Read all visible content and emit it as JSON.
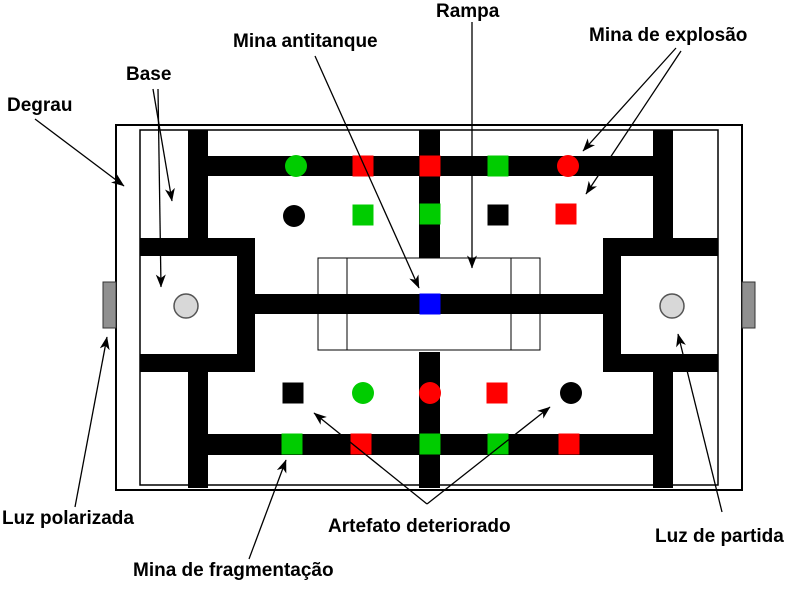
{
  "figure": {
    "background": "#ffffff",
    "colors": {
      "wall": "#000000",
      "green": "#00cc00",
      "red": "#ff0000",
      "blue": "#0000ff",
      "black": "#000000",
      "step_gray": "#909090",
      "light_gray": "#d8d8d8",
      "light_stroke": "#555555"
    },
    "labels": [
      {
        "id": "degrau",
        "text": "Degrau",
        "x": 7,
        "y": 95
      },
      {
        "id": "base",
        "text": "Base",
        "x": 126,
        "y": 64
      },
      {
        "id": "mina-antitanque",
        "text": "Mina antitanque",
        "x": 233,
        "y": 31
      },
      {
        "id": "rampa",
        "text": "Rampa",
        "x": 436,
        "y": 1
      },
      {
        "id": "mina-de-explosao",
        "text": "Mina de explosão",
        "x": 589,
        "y": 25
      },
      {
        "id": "luz-polarizada",
        "text": "Luz polarizada",
        "x": 2,
        "y": 508
      },
      {
        "id": "mina-de-fragmentacao",
        "text": "Mina de fragmentação",
        "x": 133,
        "y": 560
      },
      {
        "id": "artefato-deteriorado",
        "text": "Artefato deteriorado",
        "x": 328,
        "y": 516
      },
      {
        "id": "luz-de-partida",
        "text": "Luz de partida",
        "x": 655,
        "y": 526
      }
    ],
    "arena": {
      "outer": {
        "x": 116,
        "y": 125,
        "w": 626,
        "h": 365
      },
      "inner": {
        "x": 140,
        "y": 130,
        "w": 578,
        "h": 355
      },
      "walls": [
        {
          "id": "left-wall-upper",
          "x": 188,
          "y": 130,
          "w": 20,
          "h": 108
        },
        {
          "id": "left-wall-lower",
          "x": 188,
          "y": 372,
          "w": 20,
          "h": 116
        },
        {
          "id": "center-wall-upper",
          "x": 419,
          "y": 130,
          "w": 21,
          "h": 128
        },
        {
          "id": "center-wall-lower",
          "x": 419,
          "y": 352,
          "w": 21,
          "h": 136
        },
        {
          "id": "right-wall-upper",
          "x": 653,
          "y": 130,
          "w": 20,
          "h": 108
        },
        {
          "id": "right-wall-lower",
          "x": 653,
          "y": 372,
          "w": 20,
          "h": 116
        },
        {
          "id": "top-path",
          "x": 208,
          "y": 156,
          "w": 445,
          "h": 20
        },
        {
          "id": "bottom-path",
          "x": 208,
          "y": 434,
          "w": 445,
          "h": 21
        },
        {
          "id": "left-base-top",
          "x": 140,
          "y": 238,
          "w": 115,
          "h": 18
        },
        {
          "id": "left-base-right",
          "x": 237,
          "y": 238,
          "w": 18,
          "h": 134
        },
        {
          "id": "left-base-bottom",
          "x": 140,
          "y": 354,
          "w": 115,
          "h": 18
        },
        {
          "id": "right-base-top",
          "x": 603,
          "y": 238,
          "w": 115,
          "h": 18
        },
        {
          "id": "right-base-left",
          "x": 603,
          "y": 238,
          "w": 18,
          "h": 134
        },
        {
          "id": "right-base-bottom",
          "x": 603,
          "y": 354,
          "w": 115,
          "h": 18
        },
        {
          "id": "center-path",
          "x": 255,
          "y": 294,
          "w": 348,
          "h": 20
        }
      ],
      "ramp": {
        "x": 318,
        "y": 258,
        "w": 222,
        "h": 92,
        "inner_lines_x": [
          347,
          511
        ]
      },
      "steps": [
        {
          "id": "left-step",
          "x": 103,
          "y": 282,
          "w": 13,
          "h": 46
        },
        {
          "id": "right-step",
          "x": 742,
          "y": 282,
          "w": 13,
          "h": 46
        }
      ],
      "lights": [
        {
          "id": "left-start-light",
          "cx": 186,
          "cy": 306,
          "r": 12
        },
        {
          "id": "right-start-light",
          "cx": 672,
          "cy": 306,
          "r": 12
        }
      ]
    },
    "mine_size": {
      "square": 21,
      "circle_r": 11
    },
    "mines": [
      {
        "shape": "circle",
        "color": "green",
        "cx": 296,
        "cy": 166
      },
      {
        "shape": "square",
        "color": "red",
        "cx": 363,
        "cy": 166
      },
      {
        "shape": "square",
        "color": "red",
        "cx": 430,
        "cy": 166
      },
      {
        "shape": "square",
        "color": "green",
        "cx": 498,
        "cy": 166
      },
      {
        "shape": "circle",
        "color": "red",
        "cx": 568,
        "cy": 166
      },
      {
        "shape": "circle",
        "color": "black",
        "cx": 294,
        "cy": 216
      },
      {
        "shape": "square",
        "color": "green",
        "cx": 363,
        "cy": 215
      },
      {
        "shape": "square",
        "color": "green",
        "cx": 430,
        "cy": 214
      },
      {
        "shape": "square",
        "color": "black",
        "cx": 498,
        "cy": 215
      },
      {
        "shape": "square",
        "color": "red",
        "cx": 566,
        "cy": 214
      },
      {
        "shape": "square",
        "color": "black",
        "cx": 293,
        "cy": 393
      },
      {
        "shape": "circle",
        "color": "green",
        "cx": 363,
        "cy": 393
      },
      {
        "shape": "circle",
        "color": "red",
        "cx": 430,
        "cy": 393
      },
      {
        "shape": "square",
        "color": "red",
        "cx": 497,
        "cy": 393
      },
      {
        "shape": "circle",
        "color": "black",
        "cx": 571,
        "cy": 393
      },
      {
        "shape": "square",
        "color": "green",
        "cx": 292,
        "cy": 444
      },
      {
        "shape": "square",
        "color": "red",
        "cx": 361,
        "cy": 444
      },
      {
        "shape": "square",
        "color": "green",
        "cx": 430,
        "cy": 444
      },
      {
        "shape": "square",
        "color": "green",
        "cx": 498,
        "cy": 444
      },
      {
        "shape": "square",
        "color": "red",
        "cx": 569,
        "cy": 444
      },
      {
        "shape": "square",
        "color": "blue",
        "cx": 430,
        "cy": 304
      }
    ],
    "arrows": [
      {
        "id": "degrau-arrow",
        "x1": 35,
        "y1": 119,
        "x2": 124,
        "y2": 186
      },
      {
        "id": "base-arrow-corridor",
        "x1": 153,
        "y1": 89,
        "x2": 172,
        "y2": 201
      },
      {
        "id": "base-arrow-square",
        "x1": 158,
        "y1": 89,
        "x2": 161,
        "y2": 287
      },
      {
        "id": "mina-antitanque-arrow",
        "x1": 315,
        "y1": 56,
        "x2": 419,
        "y2": 288
      },
      {
        "id": "rampa-arrow",
        "x1": 472,
        "y1": 22,
        "x2": 472,
        "y2": 268
      },
      {
        "id": "mina-explosao-arrow-1",
        "x1": 676,
        "y1": 48,
        "x2": 583,
        "y2": 151
      },
      {
        "id": "mina-explosao-arrow-2",
        "x1": 681,
        "y1": 51,
        "x2": 586,
        "y2": 194
      },
      {
        "id": "luz-polarizada-arrow",
        "x1": 75,
        "y1": 507,
        "x2": 107,
        "y2": 337
      },
      {
        "id": "mina-fragmentacao-arrow",
        "x1": 249,
        "y1": 559,
        "x2": 286,
        "y2": 460
      },
      {
        "id": "artefato-arrow-square",
        "x1": 427,
        "y1": 504,
        "x2": 314,
        "y2": 413
      },
      {
        "id": "artefato-arrow-circle",
        "x1": 427,
        "y1": 504,
        "x2": 550,
        "y2": 407
      },
      {
        "id": "luz-de-partida-arrow",
        "x1": 722,
        "y1": 512,
        "x2": 678,
        "y2": 334
      }
    ]
  }
}
